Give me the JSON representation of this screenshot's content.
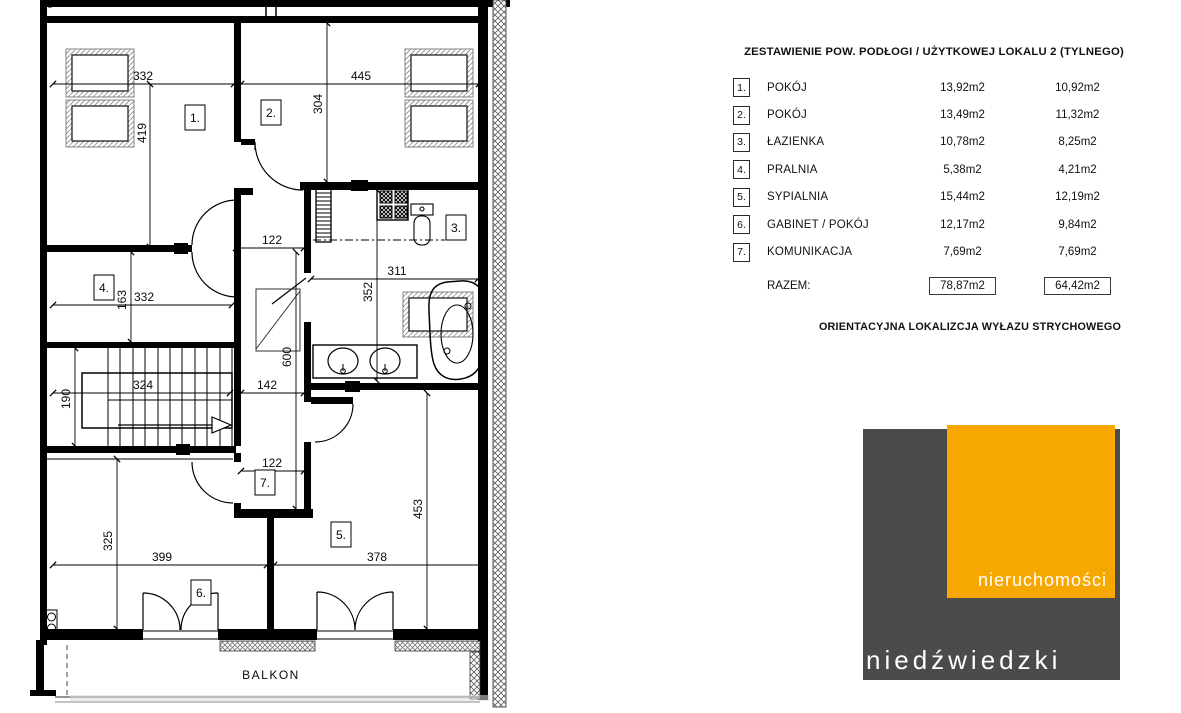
{
  "plan": {
    "dims": [
      "332",
      "445",
      "419",
      "304",
      "122",
      "311",
      "352",
      "163",
      "332",
      "600",
      "324",
      "190",
      "142",
      "122",
      "453",
      "325",
      "399",
      "378"
    ],
    "rooms": [
      "1.",
      "2.",
      "3.",
      "4.",
      "5.",
      "6.",
      "7."
    ],
    "balcony_label": "BALKON"
  },
  "table": {
    "title": "ZESTAWIENIE POW. PODŁOGI / UŻYTKOWEJ LOKALU 2 (TYLNEGO)",
    "rows": [
      {
        "no": "1.",
        "name": "POKÓJ",
        "floor": "13,92m2",
        "usable": "10,92m2"
      },
      {
        "no": "2.",
        "name": "POKÓJ",
        "floor": "13,49m2",
        "usable": "11,32m2"
      },
      {
        "no": "3.",
        "name": "ŁAZIENKA",
        "floor": "10,78m2",
        "usable": "8,25m2"
      },
      {
        "no": "4.",
        "name": "PRALNIA",
        "floor": "5,38m2",
        "usable": "4,21m2"
      },
      {
        "no": "5.",
        "name": "SYPIALNIA",
        "floor": "15,44m2",
        "usable": "12,19m2"
      },
      {
        "no": "6.",
        "name": "GABINET / POKÓJ",
        "floor": "12,17m2",
        "usable": "9,84m2"
      },
      {
        "no": "7.",
        "name": "KOMUNIKACJA",
        "floor": "7,69m2",
        "usable": "7,69m2"
      }
    ],
    "total_label": "RAZEM:",
    "total_floor": "78,87m2",
    "total_usable": "64,42m2"
  },
  "note": "ORIENTACYJNA LOKALIZCJA WYŁAZU STRYCHOWEGO",
  "logo": {
    "top_word": "nieruchomości",
    "bottom_word": "niedźwiedzki",
    "yellow": "#F6A800",
    "gray": "#4B4B4B"
  }
}
